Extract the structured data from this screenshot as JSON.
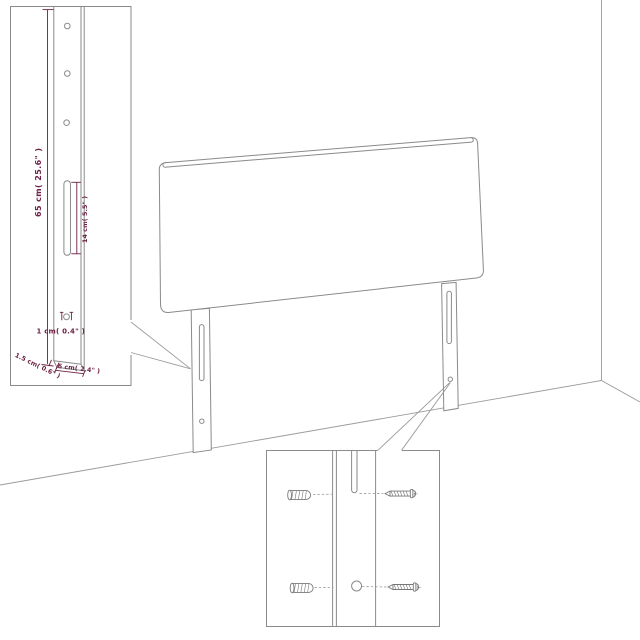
{
  "diagram": {
    "subject": "headboard-wall-mount-assembly",
    "accent_color": "#6e2145",
    "line_color": "#8a8a8a",
    "background_color": "#ffffff"
  },
  "leg_inset": {
    "dim_height": "65 cm( 25.6\" )",
    "dim_slot": "14 cm( 5.5\" )",
    "dim_hole": "1 cm( 0.4\" )",
    "dim_thickness": "1.5 cm( 0.6\" )",
    "dim_width": "6 cm( 2.4\" )",
    "mounting_hole_count": "3"
  },
  "hardware_inset": {
    "icons": [
      "wall-plug-icon",
      "screw-icon",
      "wall-plug-icon",
      "screw-icon"
    ]
  }
}
